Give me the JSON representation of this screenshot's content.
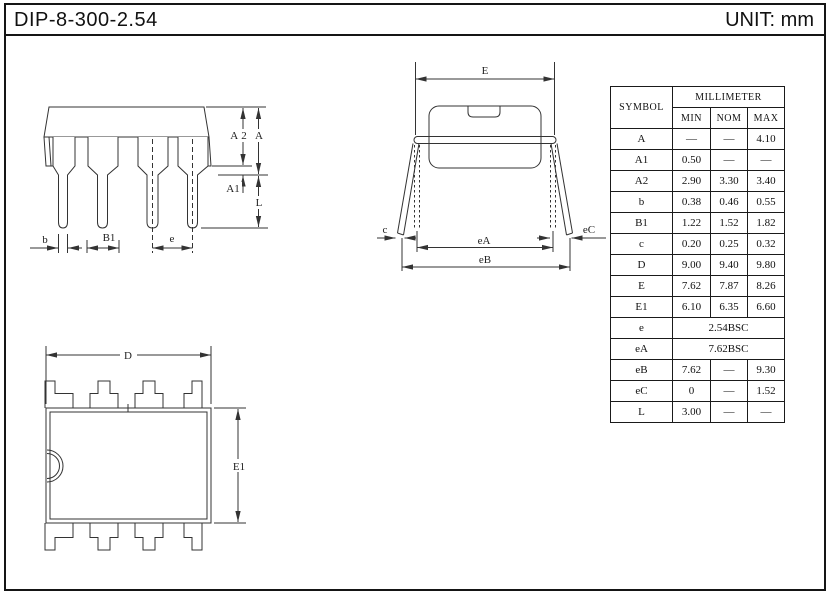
{
  "page": {
    "title": "DIP-8-300-2.54",
    "unit": "UNIT: mm"
  },
  "table": {
    "symbol_header": "SYMBOL",
    "unit_group_header": "MILLIMETER",
    "sub_headers": [
      "MIN",
      "NOM",
      "MAX"
    ],
    "rows": [
      {
        "symbol": "A",
        "values": [
          "—",
          "—",
          "4.10"
        ]
      },
      {
        "symbol": "A1",
        "values": [
          "0.50",
          "—",
          "—"
        ]
      },
      {
        "symbol": "A2",
        "values": [
          "2.90",
          "3.30",
          "3.40"
        ]
      },
      {
        "symbol": "b",
        "values": [
          "0.38",
          "0.46",
          "0.55"
        ]
      },
      {
        "symbol": "B1",
        "values": [
          "1.22",
          "1.52",
          "1.82"
        ]
      },
      {
        "symbol": "c",
        "values": [
          "0.20",
          "0.25",
          "0.32"
        ]
      },
      {
        "symbol": "D",
        "values": [
          "9.00",
          "9.40",
          "9.80"
        ]
      },
      {
        "symbol": "E",
        "values": [
          "7.62",
          "7.87",
          "8.26"
        ]
      },
      {
        "symbol": "E1",
        "values": [
          "6.10",
          "6.35",
          "6.60"
        ]
      },
      {
        "symbol": "e",
        "merged": "2.54BSC"
      },
      {
        "symbol": "eA",
        "merged": "7.62BSC"
      },
      {
        "symbol": "eB",
        "values": [
          "7.62",
          "—",
          "9.30"
        ]
      },
      {
        "symbol": "eC",
        "values": [
          "0",
          "—",
          "1.52"
        ]
      },
      {
        "symbol": "L",
        "values": [
          "3.00",
          "—",
          "—"
        ]
      }
    ]
  },
  "side_view": {
    "dims": {
      "a2": "A2",
      "a": "A",
      "a1": "A1",
      "l": "L",
      "b": "b",
      "b1": "B1",
      "e": "e"
    }
  },
  "end_view": {
    "dims": {
      "e": "E",
      "ea": "eA",
      "eb": "eB",
      "c": "c",
      "ec": "eC"
    }
  },
  "top_view": {
    "dims": {
      "d": "D",
      "e1": "E1"
    }
  },
  "colors": {
    "line": "#333333",
    "text": "#111111"
  }
}
